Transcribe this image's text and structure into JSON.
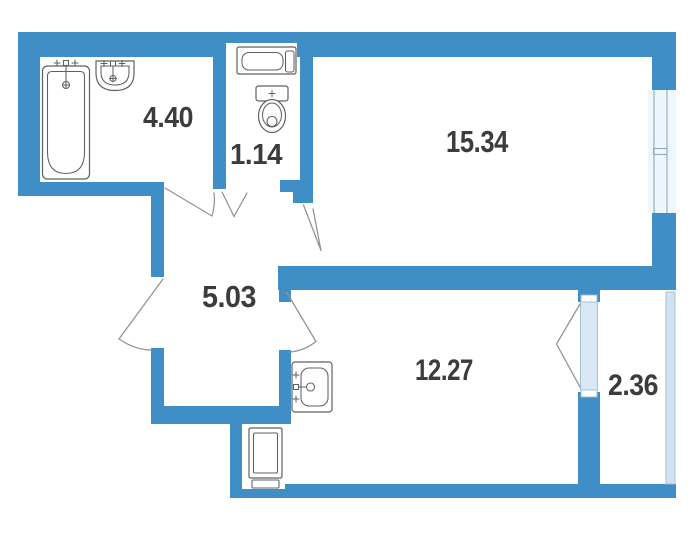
{
  "plan": {
    "type": "apartment-floor-plan",
    "rooms": [
      {
        "name": "bathroom",
        "area_m2": "4.40"
      },
      {
        "name": "wc",
        "area_m2": "1.14"
      },
      {
        "name": "living-room",
        "area_m2": "15.34"
      },
      {
        "name": "hallway",
        "area_m2": "5.03"
      },
      {
        "name": "kitchen",
        "area_m2": "12.27"
      },
      {
        "name": "balcony",
        "area_m2": "2.36"
      }
    ],
    "fixtures": [
      "bathtub",
      "bathroom-sink",
      "toilet",
      "washing-machine",
      "kitchen-sink",
      "refrigerator"
    ],
    "colors": {
      "wall": "#3f8ec5",
      "room_fill": "#ffffff",
      "glass": "#d9e8f4",
      "balcony_glazing": "#cfe3f2",
      "label_text": "#3c3c3e",
      "fixture_outline": "#5d6165",
      "door_line": "#8f9396"
    }
  }
}
